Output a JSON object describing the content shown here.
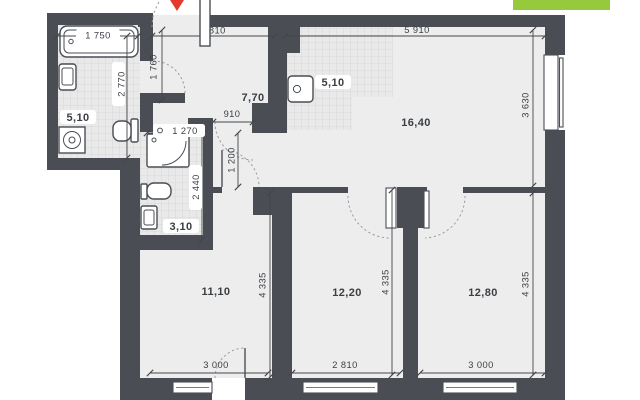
{
  "plan": {
    "rooms": {
      "bathroom": {
        "area": "5,10"
      },
      "kitchen_zone": {
        "area": "5,10"
      },
      "hallway": {
        "area": "7,70"
      },
      "living_room": {
        "area": "16,40"
      },
      "wc": {
        "area": "3,10"
      },
      "bedroom_left": {
        "area": "11,10"
      },
      "bedroom_middle": {
        "area": "12,20"
      },
      "bedroom_right": {
        "area": "12,80"
      }
    },
    "dimensions": {
      "bath_width": "1 750",
      "bath_depth": "2 770",
      "entry_width": "2 810",
      "entry_depth": "1 760",
      "living_width": "5 910",
      "living_depth": "3 630",
      "corridor_opening": "910",
      "wc_width": "1 270",
      "wc_depth": "2 440",
      "passage_width": "1 200",
      "bedroom_left_depth": "4 335",
      "bedroom_middle_depth": "4 335",
      "bedroom_right_depth": "4 335",
      "bedroom_left_width": "3 000",
      "bedroom_middle_width": "2 810",
      "bedroom_right_width": "3 000"
    },
    "colors": {
      "wall": "#4a4e54",
      "floor": "#ededed",
      "badge_green": "#97c93d",
      "marker_red": "#e23a2c"
    }
  }
}
